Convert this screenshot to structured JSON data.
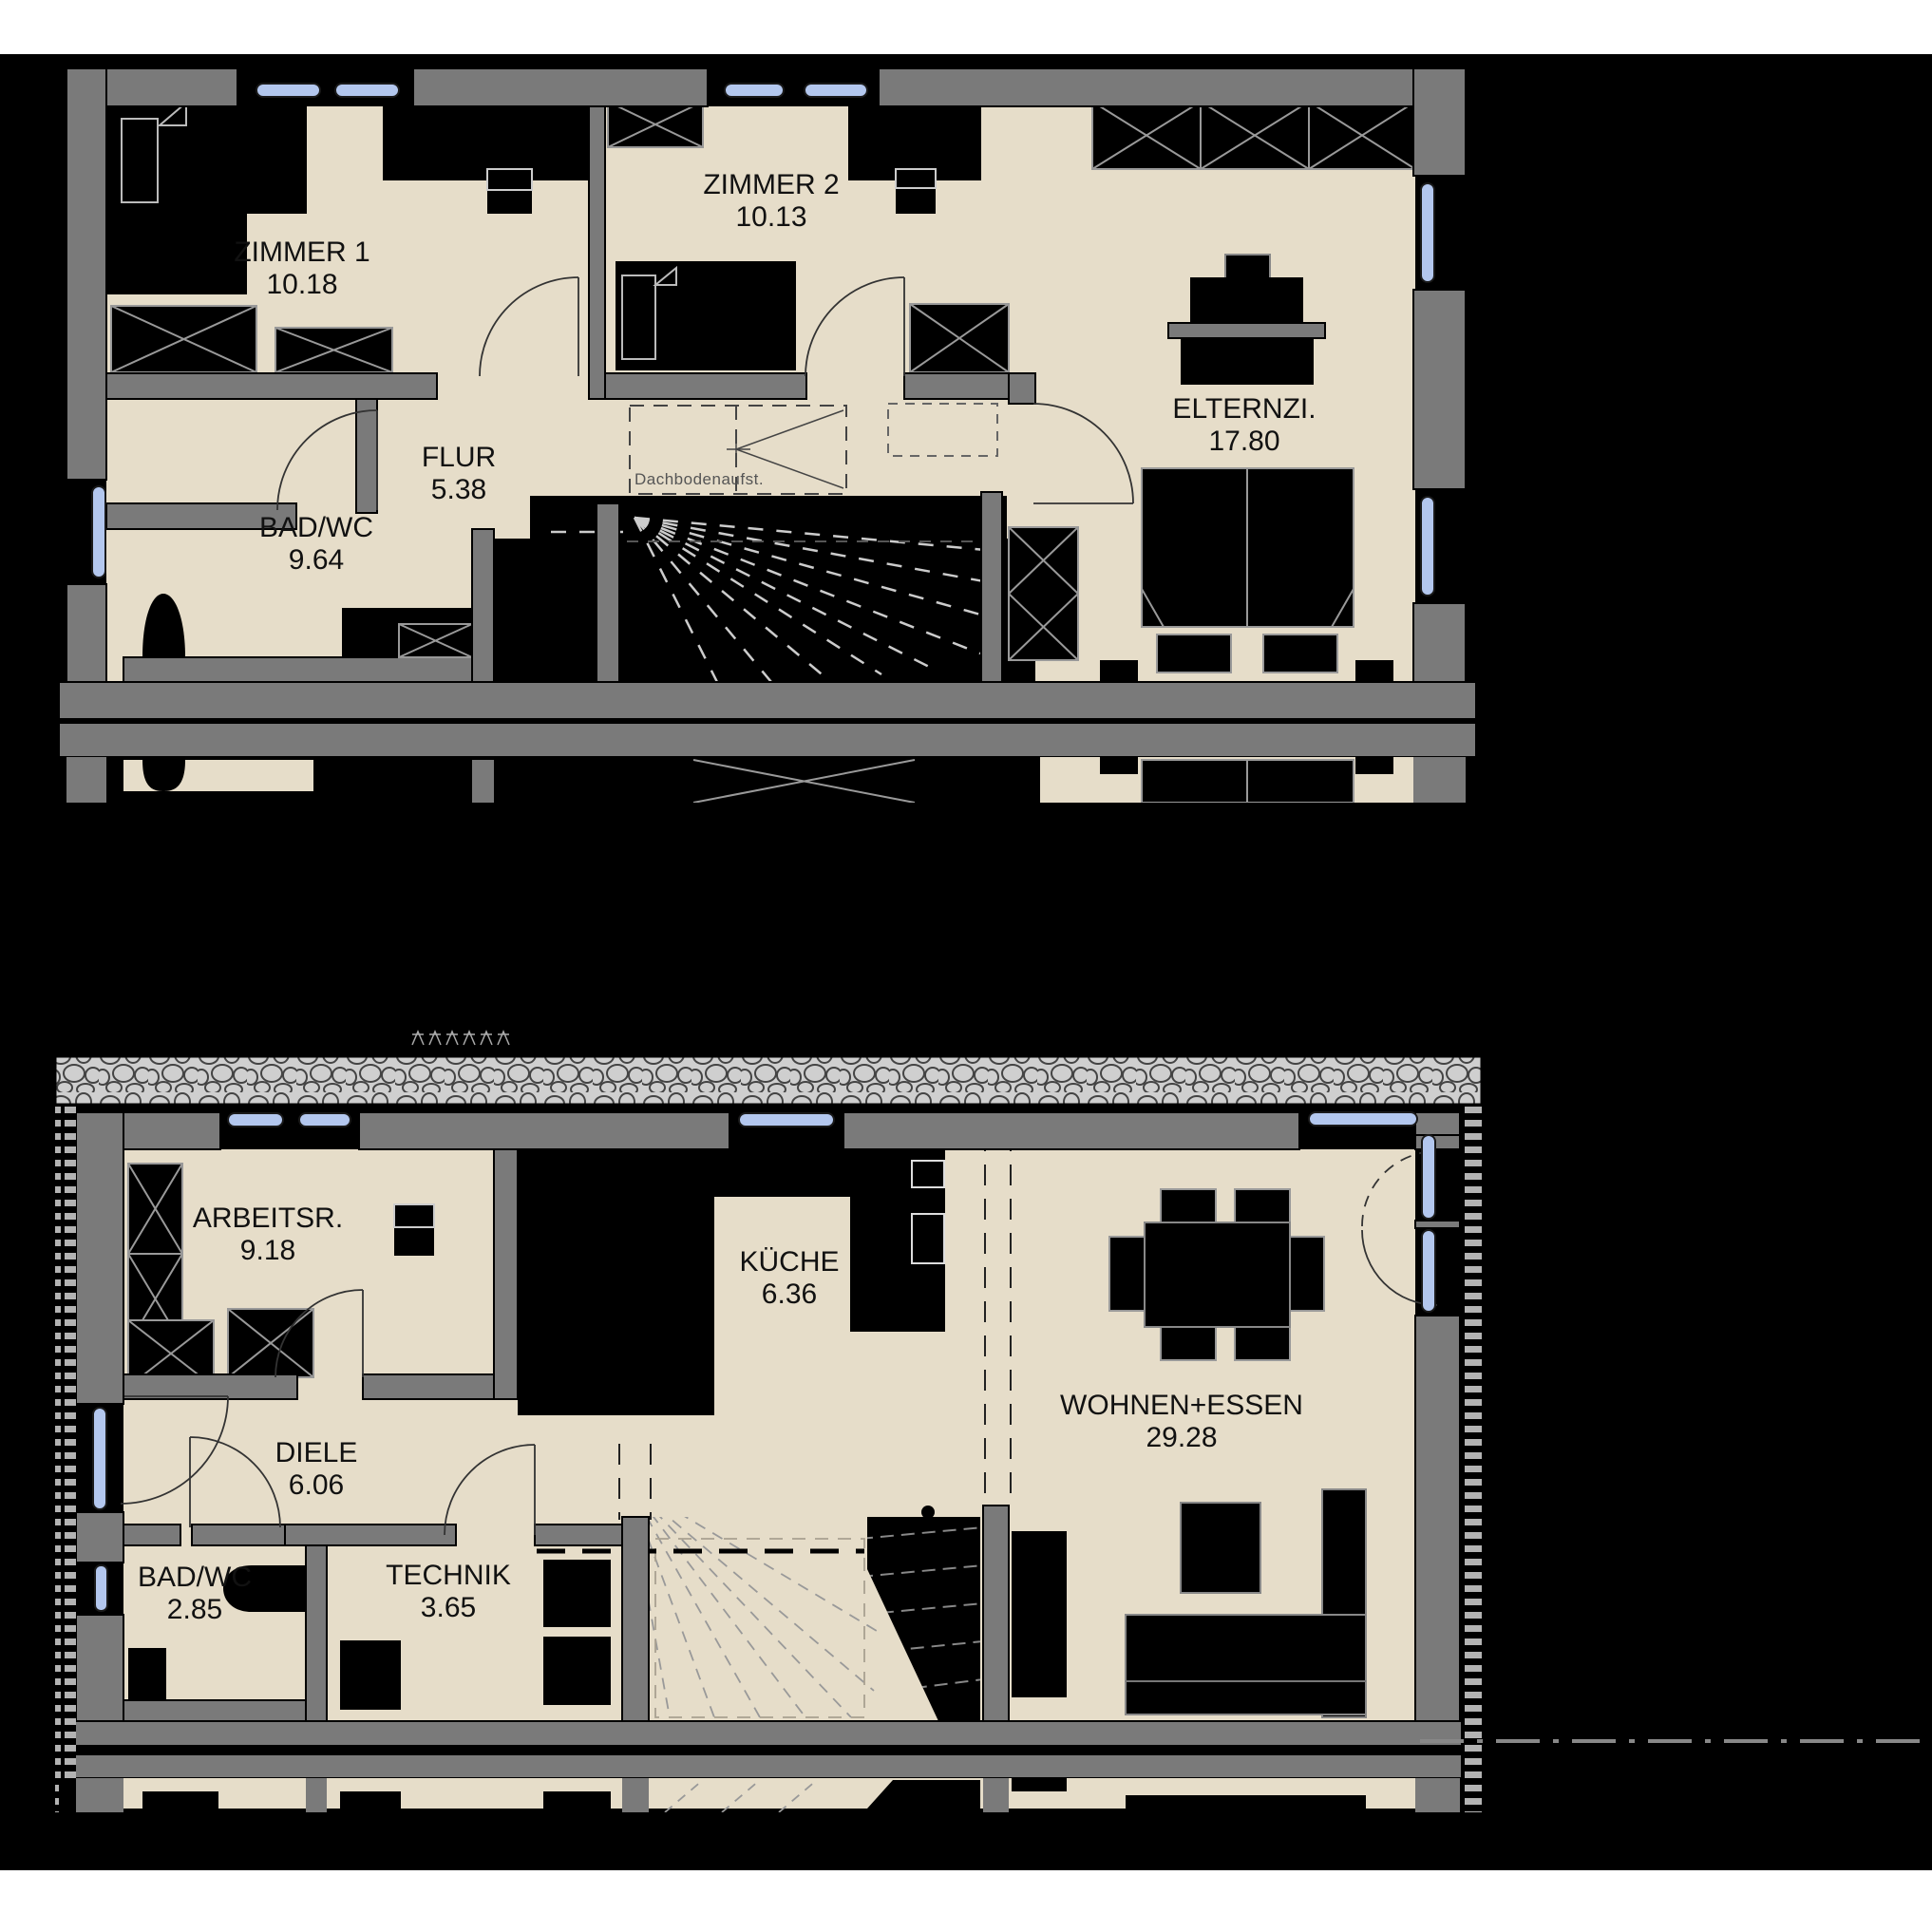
{
  "drawing": {
    "kind": "floor-plan",
    "colors": {
      "background": "#000000",
      "paper": "#ffffff",
      "room_fill": "#e6ddc9",
      "wall_gray": "#7a7a7a",
      "window_blue": "#b3c7ee",
      "furniture_outline": "#999999"
    },
    "upper_floor": {
      "rooms": [
        {
          "name": "ZIMMER 1",
          "area": "10.18"
        },
        {
          "name": "ZIMMER 2",
          "area": "10.13"
        },
        {
          "name": "ELTERNZI.",
          "area": "17.80"
        },
        {
          "name": "FLUR",
          "area": "5.38"
        },
        {
          "name": "BAD/WC",
          "area": "9.64"
        }
      ],
      "annotation": "Dachbodenaufst."
    },
    "ground_floor": {
      "rooms": [
        {
          "name": "ARBEITSR.",
          "area": "9.18"
        },
        {
          "name": "KÜCHE",
          "area": "6.36"
        },
        {
          "name": "WOHNEN+ESSEN",
          "area": "29.28"
        },
        {
          "name": "DIELE",
          "area": "6.06"
        },
        {
          "name": "BAD/WC",
          "area": "2.85"
        },
        {
          "name": "TECHNIK",
          "area": "3.65"
        }
      ]
    }
  }
}
